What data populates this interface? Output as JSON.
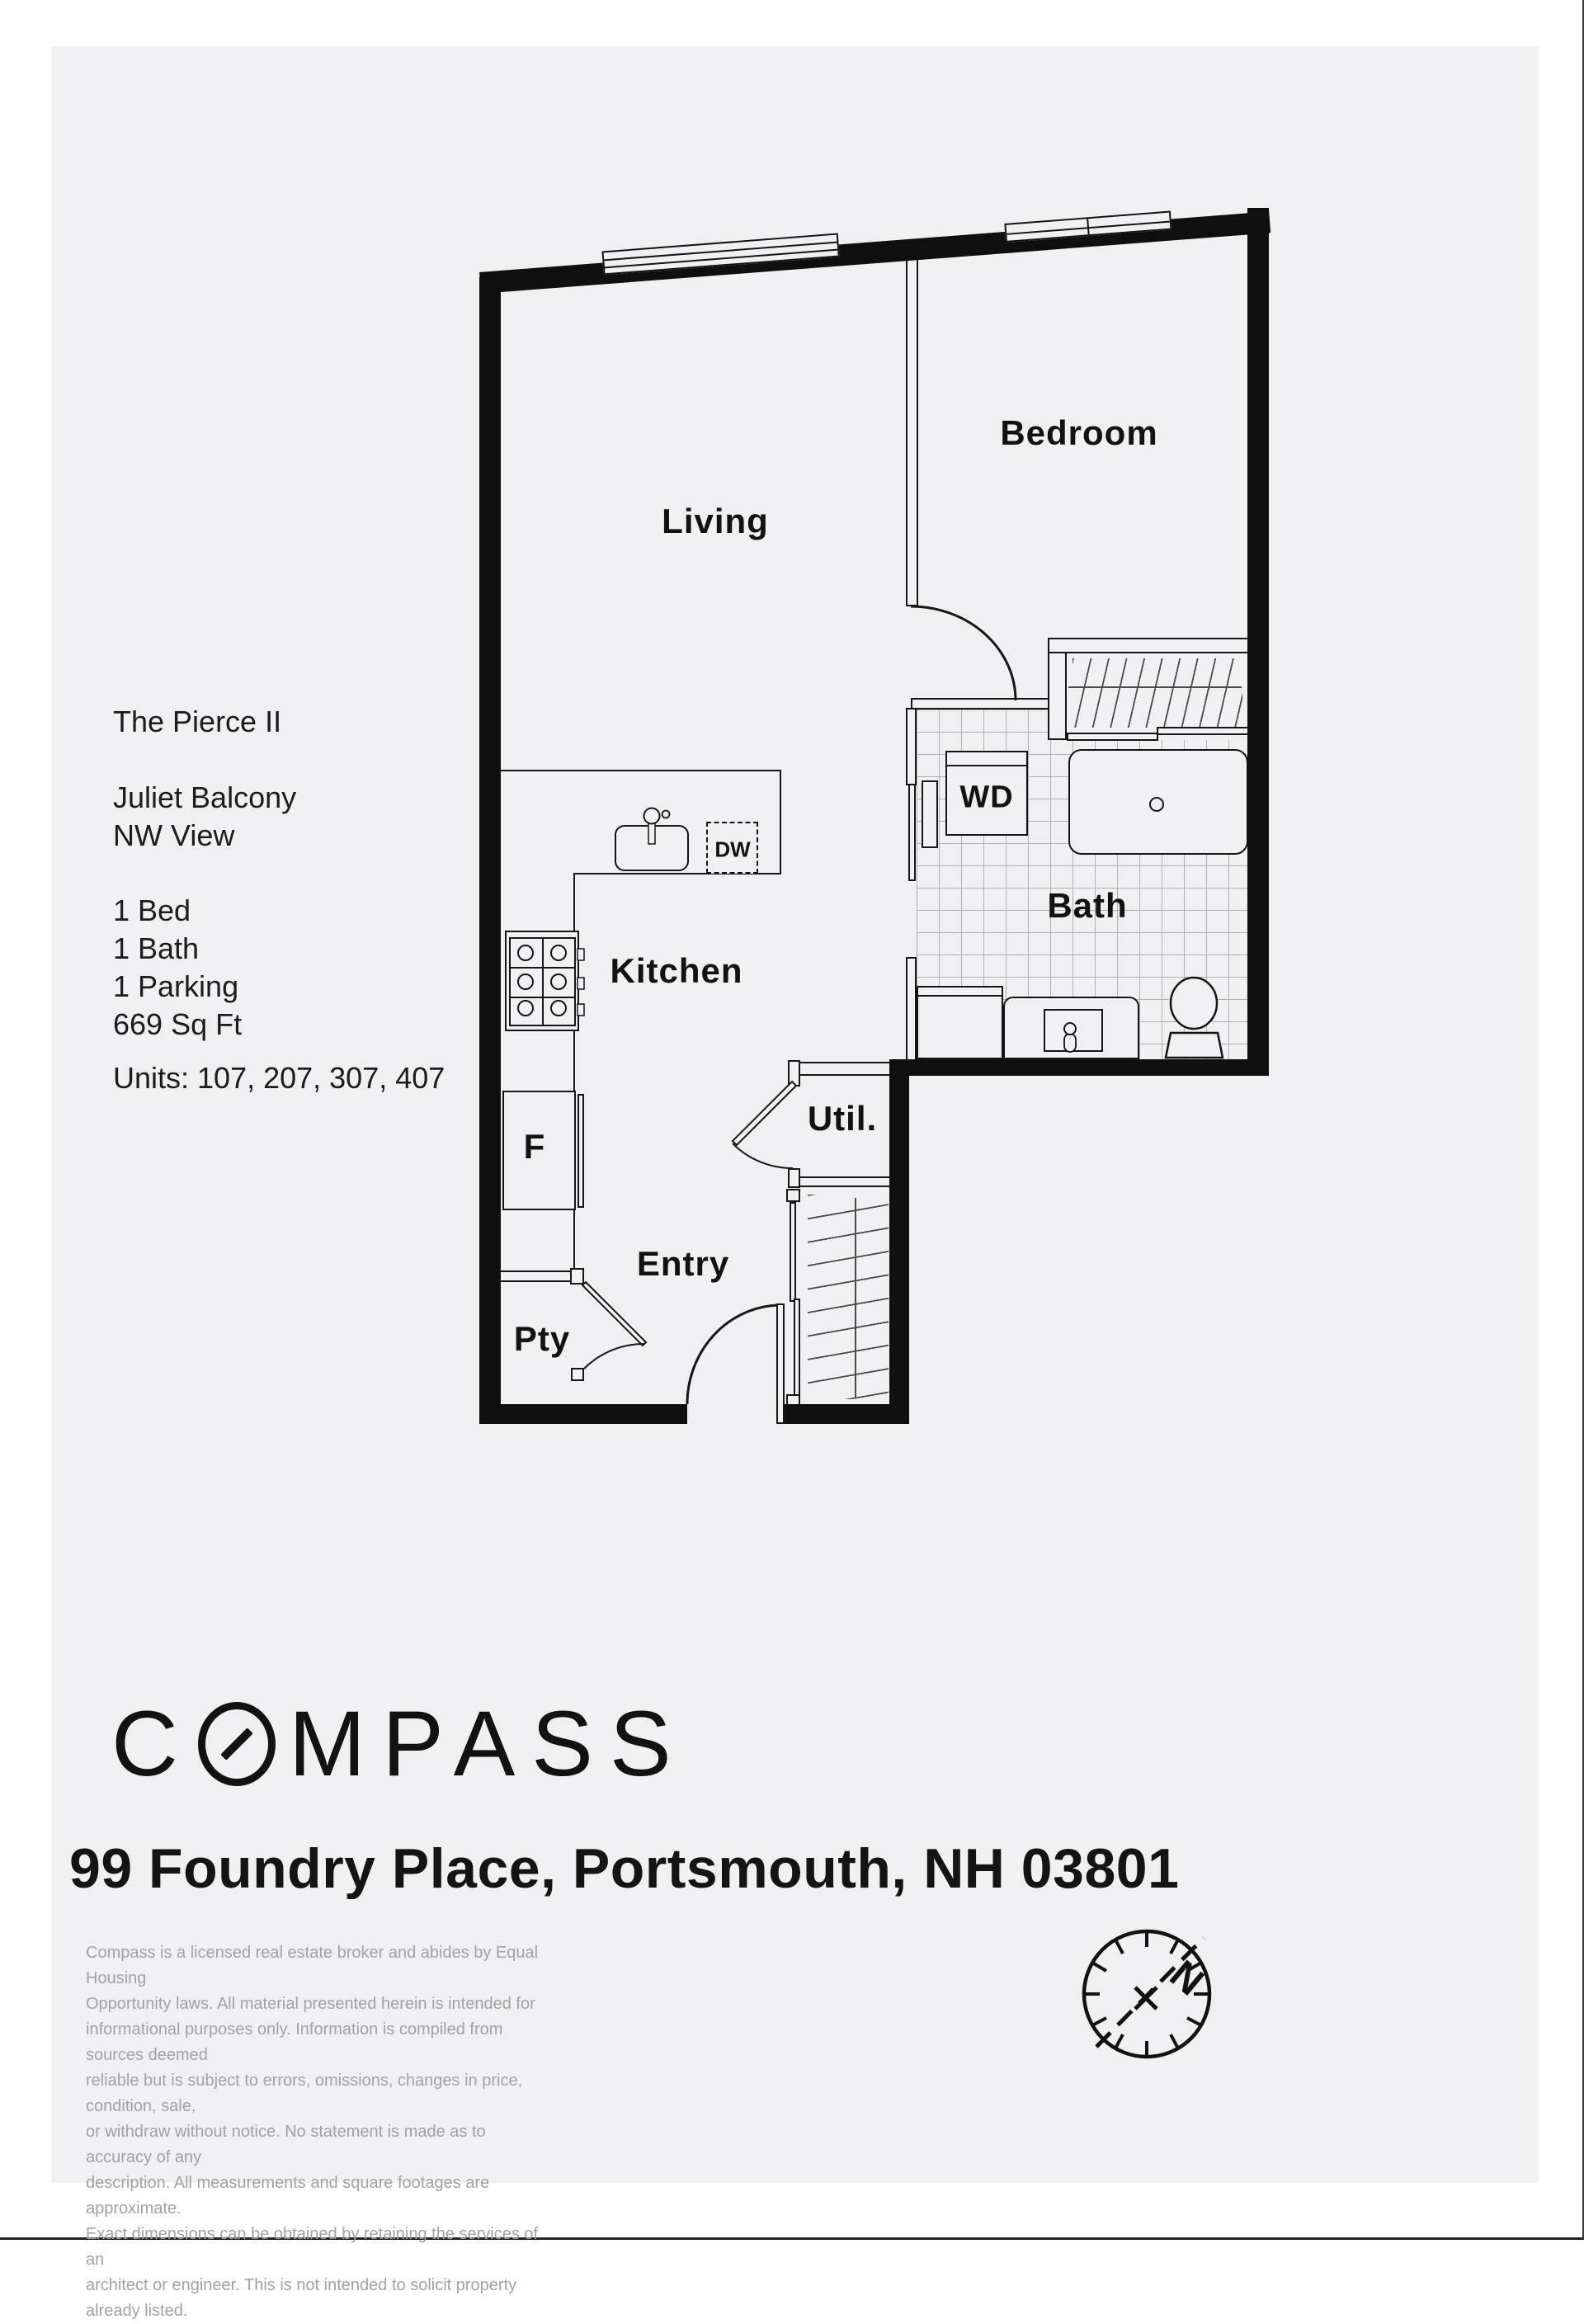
{
  "info": {
    "building": "The Pierce II",
    "balcony": "Juliet Balcony",
    "view": "NW View",
    "bed": "1 Bed",
    "bath": "1 Bath",
    "parking": "1 Parking",
    "sqft": "669 Sq Ft",
    "units": "Units: 107, 207, 307, 407"
  },
  "rooms": {
    "living": "Living",
    "bedroom": "Bedroom",
    "kitchen": "Kitchen",
    "bath": "Bath",
    "entry": "Entry",
    "utility": "Util.",
    "pantry": "Pty"
  },
  "fixtures": {
    "washer_dryer": "WD",
    "dishwasher": "DW",
    "fridge": "F"
  },
  "brand": {
    "logo_c": "C",
    "logo_rest": "MPASS",
    "address": "99 Foundry Place, Portsmouth, NH 03801"
  },
  "compass_rose": {
    "north_label": "N"
  },
  "disclaimer": {
    "text": "Compass is a licensed real estate broker and abides by Equal Housing\nOpportunity laws. All material presented herein is intended for\ninformational purposes only. Information is compiled from sources deemed\nreliable but is subject to errors, omissions, changes in price, condition, sale,\nor withdraw without notice. No statement is made as to accuracy of any\ndescription. All measurements and square footages are approximate.\nExact dimensions can be obtained by retaining the services of an\narchitect or engineer. This is not intended to solicit property already listed."
  },
  "colors": {
    "wall": "#0f0f0f",
    "sheet_background": "#f0f0f2",
    "plan_line": "#161616",
    "tile_line": "#9b9b9b",
    "text": "#151515",
    "disclaimer_text": "#a2a2a5"
  }
}
